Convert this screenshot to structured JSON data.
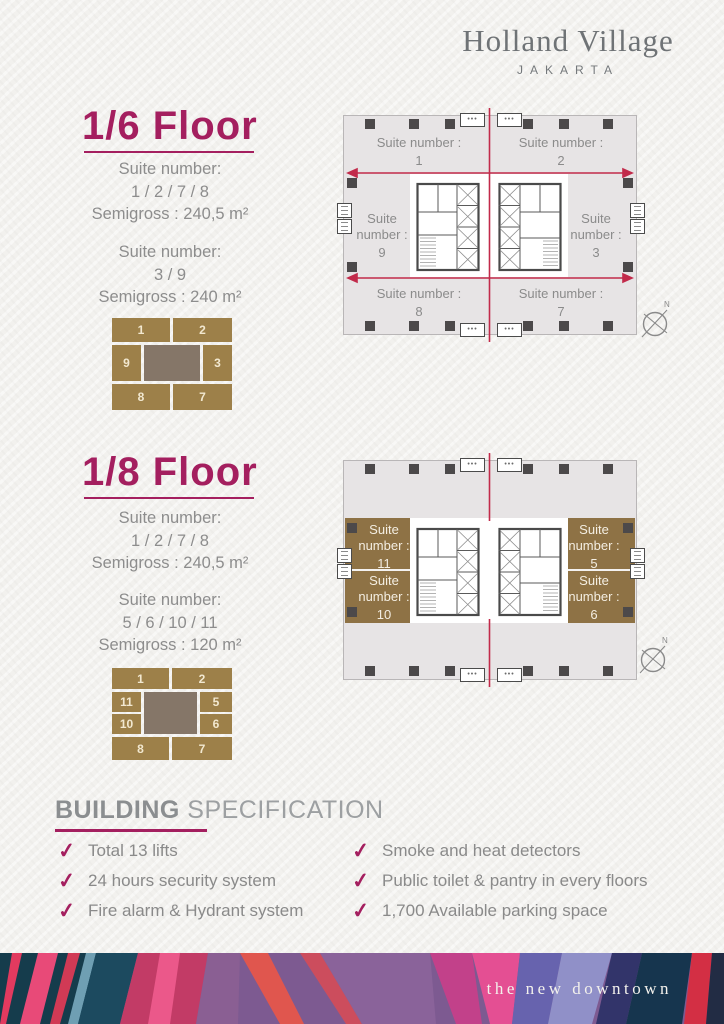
{
  "brand": {
    "name": "Holland Village",
    "city": "JAKARTA",
    "tagline": "the new downtown"
  },
  "colors": {
    "accent_magenta": "#a41f5f",
    "red_line": "#c22a4a",
    "gold_block": "#9d8049",
    "plan_gold_band": "#8e7245",
    "core_gray": "#857668",
    "text_gray": "#8b8b8b",
    "plan_background": "#e7e4e5"
  },
  "floors": [
    {
      "title": "1/6 Floor",
      "specs": [
        {
          "label": "Suite number:",
          "numbers": "1 / 2 / 7 / 8",
          "semigross": "Semigross : 240,5 m²"
        },
        {
          "label": "Suite number:",
          "numbers": "3 / 9",
          "semigross": "Semigross : 240 m²"
        }
      ],
      "mini": {
        "top": [
          "1",
          "2"
        ],
        "left": [
          "9"
        ],
        "right": [
          "3"
        ],
        "bottom": [
          "8",
          "7"
        ]
      },
      "plan": {
        "label_prefix": "Suite number :",
        "suites": [
          "1",
          "2",
          "9",
          "3",
          "8",
          "7"
        ],
        "compass": "N"
      }
    },
    {
      "title": "1/8 Floor",
      "specs": [
        {
          "label": "Suite number:",
          "numbers": "1 / 2 / 7 / 8",
          "semigross": "Semigross : 240,5 m²"
        },
        {
          "label": "Suite number:",
          "numbers": "5 / 6 / 10 / 11",
          "semigross": "Semigross : 120 m²"
        }
      ],
      "mini": {
        "top": [
          "1",
          "2"
        ],
        "left": [
          "11",
          "10"
        ],
        "right": [
          "5",
          "6"
        ],
        "bottom": [
          "8",
          "7"
        ]
      },
      "plan": {
        "label_prefix": "Suite number :",
        "suites": [
          "11",
          "5",
          "10",
          "6"
        ],
        "compass": "N"
      }
    }
  ],
  "building_spec": {
    "title_bold": "BUILDING",
    "title_light": " SPECIFICATION",
    "items_left": [
      "Total 13 lifts",
      "24 hours security system",
      "Fire alarm & Hydrant system"
    ],
    "items_right": [
      "Smoke and heat detectors",
      "Public toilet & pantry in every floors",
      "1,700 Available parking space"
    ]
  }
}
